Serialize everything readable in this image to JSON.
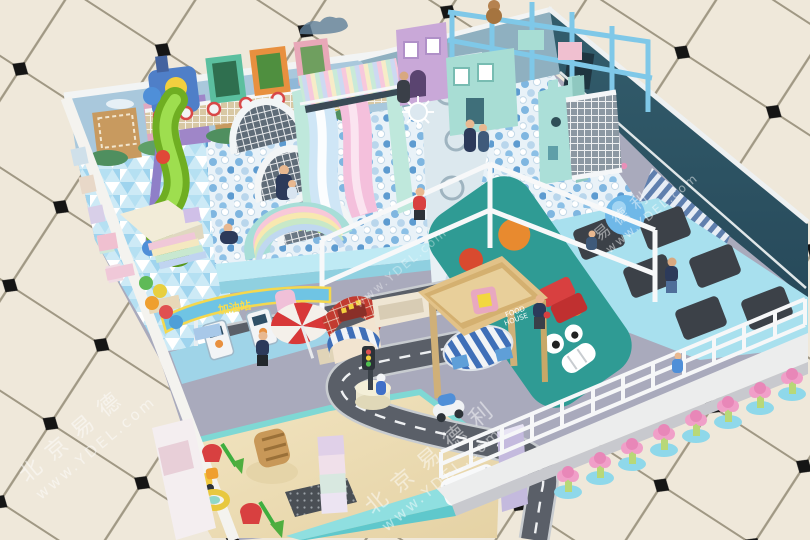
{
  "meta": {
    "scene_title": "Indoor children's soft play park — 3D design render",
    "view": "isometric overview of playground room on tiled mall floor"
  },
  "watermark": {
    "brand_cn": "北京易德利",
    "brand_cn_short": "易德利",
    "brand_cn_city": "北京易德",
    "url": "www.YDEL.com"
  },
  "signs": {
    "gas_station": "加油站",
    "food_house_line1": "FOOD",
    "food_house_line2": "HOUSE"
  },
  "palette": {
    "tile": "#efe8da",
    "grout": "#a09884",
    "tile_diamond": "#151515",
    "room_floor": "#a9aabc",
    "ball_pit_base": "#e9f2f8",
    "ball_blue": "#7fb6e0",
    "toddler_floor": "#cdeaf6",
    "sand": "#eedfb6",
    "road": "#5a5f68",
    "mint_wall": "#8fdfe0",
    "teal_character_wall": "#2f9b94",
    "dark_wall": "#2c5563",
    "mural_sky": "#a9c8dc",
    "slide_pink": "#f4c0dc",
    "slide_blue": "#cfe6f6",
    "tube_slide_green": "#86cc33",
    "red_accent": "#d84040",
    "wood": "#e2c288",
    "trampoline_bed": "#3c4148",
    "trampoline_pad": "#a8e0ee",
    "gym_ball": "#6fb8e8",
    "flower_stool_pink": "#f09fc8"
  },
  "zones": [
    {
      "name": "toddler-soft-play",
      "floor": "light blue triangle mosaic"
    },
    {
      "name": "ball-pit",
      "floor": "white and blue ocean balls"
    },
    {
      "name": "trampoline-court",
      "beds": 6
    },
    {
      "name": "roadway-town",
      "road_shape": "S-curve with white dashes"
    },
    {
      "name": "sand-pit",
      "toys": [
        "bucket",
        "shovel",
        "truck",
        "ring",
        "sand chair"
      ]
    },
    {
      "name": "mall-exterior",
      "floor": "cream tiles with black diamonds"
    }
  ],
  "objects": {
    "wave_slide_lanes": 2,
    "arch_net_tunnels": 3,
    "spiral_tube_slides": 1,
    "flower_stools": 8,
    "trampoline_beds": 6,
    "gym_ball": 1,
    "people": 12,
    "wall_train_frames": 3,
    "playhouses": 3,
    "castle_towers": 1
  }
}
